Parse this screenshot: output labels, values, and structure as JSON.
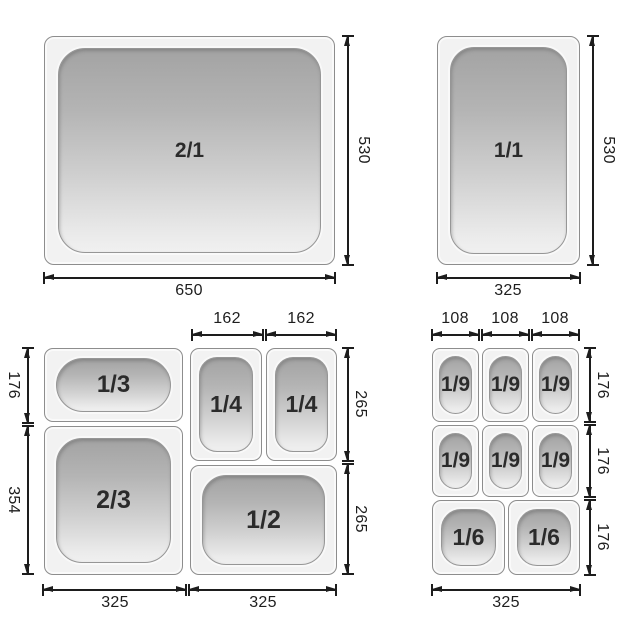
{
  "diagram_title": "Gastronorm pan size diagram",
  "colors": {
    "pan_fill": "#f2f2f2",
    "pan_border": "#8d8d8d",
    "well_gradient_top": "#a3a3a3",
    "well_gradient_bottom": "#f0f0f0",
    "dimension_line": "#1d1d1d",
    "label_text": "#2b2b2b"
  },
  "panels": {
    "top_left": {
      "pan_label": "2/1",
      "bottom_dim": "650",
      "right_dim": "530"
    },
    "top_right": {
      "pan_label": "1/1",
      "bottom_dim": "325",
      "right_dim": "530"
    },
    "bottom_left": {
      "pan_labels": [
        "1/3",
        "1/4",
        "1/4",
        "2/3",
        "1/2"
      ],
      "top_dims": [
        "162",
        "162"
      ],
      "left_dims": [
        "176",
        "354"
      ],
      "right_dims": [
        "265",
        "265"
      ],
      "bottom_dims": [
        "325",
        "325"
      ]
    },
    "bottom_right": {
      "pan_labels": [
        "1/9",
        "1/9",
        "1/9",
        "1/9",
        "1/9",
        "1/9",
        "1/6",
        "1/6"
      ],
      "top_dims": [
        "108",
        "108",
        "108"
      ],
      "right_dims": [
        "176",
        "176",
        "176"
      ],
      "bottom_dims": [
        "325"
      ]
    }
  }
}
